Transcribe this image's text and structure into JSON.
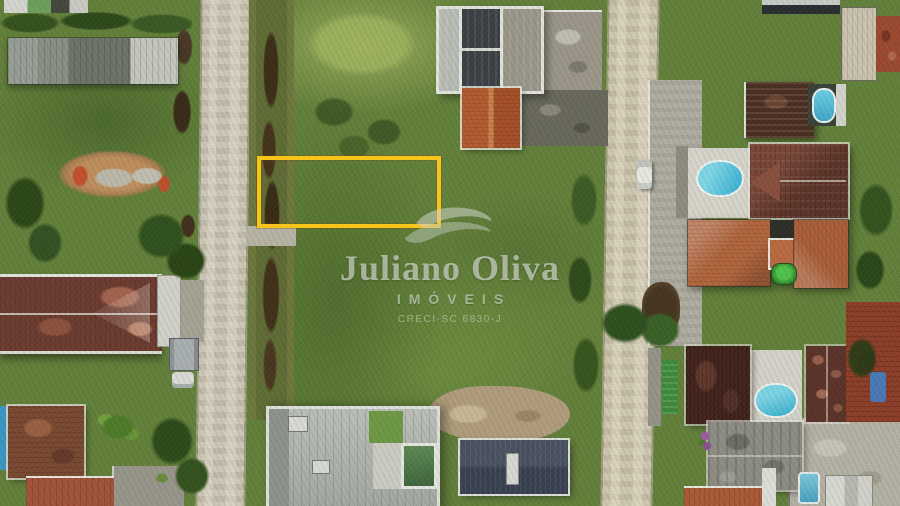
{
  "image": {
    "type": "aerial-drone-photo",
    "description": "Top-down drone photograph of a suburban block: two parallel sandy dirt roads running vertically, a dark drainage canal beside the left road, grassy vacant lots in the center, and houses with terracotta, maroon, gray and navy roofs plus swimming pools on both sides. A land plot for sale is outlined in yellow.",
    "width": 900,
    "height": 506
  },
  "watermark": {
    "logo": "wave-swoosh-icon",
    "brand": "Juliano Oliva",
    "division": "IMÓVEIS",
    "license": "CRECI-SC 6830-J",
    "color": "#DDE1D9"
  },
  "highlight": {
    "meaning": "boundary of the advertised land plot, straddling the canal and grass field",
    "color": "#F6C41B",
    "x": 257,
    "y": 156,
    "w": 176,
    "h": 64,
    "border_px": 4
  },
  "palette": {
    "grass": "#64813C",
    "grass_light": "#9DB45F",
    "trees_dark": "#2D4B1A",
    "road_sand": "#CCC5B5",
    "canal_water": "#3D2E18",
    "dirt_patch": "#C08F5F",
    "roof_terracotta": "#B4663F",
    "roof_maroon": "#5E342A",
    "roof_dark_navy": "#3C4046",
    "roof_gray": "#8E8E86",
    "pool_blue": "#3FB9DB",
    "pool_green": "#41663E",
    "white_walls": "#E4E5DF"
  },
  "scene": {
    "elements": [
      "left-dirt-road",
      "right-dirt-road",
      "drainage-canal",
      "bridge-slab",
      "plot-highlight-rectangle",
      "grass-field-center",
      "red-dirt-patch",
      "long-gray-warehouse",
      "maroon-roof-house-left",
      "construction-house-top-center",
      "orange-roof-house-top-center",
      "modern-flat-roof-house-bottom",
      "navy-roof-house-bottom",
      "dark-brown-roof-house-right",
      "big-dark-red-roof-house-right",
      "terracotta-roof-complex-right",
      "maroon-roof-house-bottom-right",
      "weathered-gray-roof-house",
      "red-tile-roofs-right-edge",
      "swimming-pools-blue",
      "green-pool",
      "white-car-on-road",
      "trailer-box",
      "tree-clusters",
      "mud-puddles"
    ]
  }
}
